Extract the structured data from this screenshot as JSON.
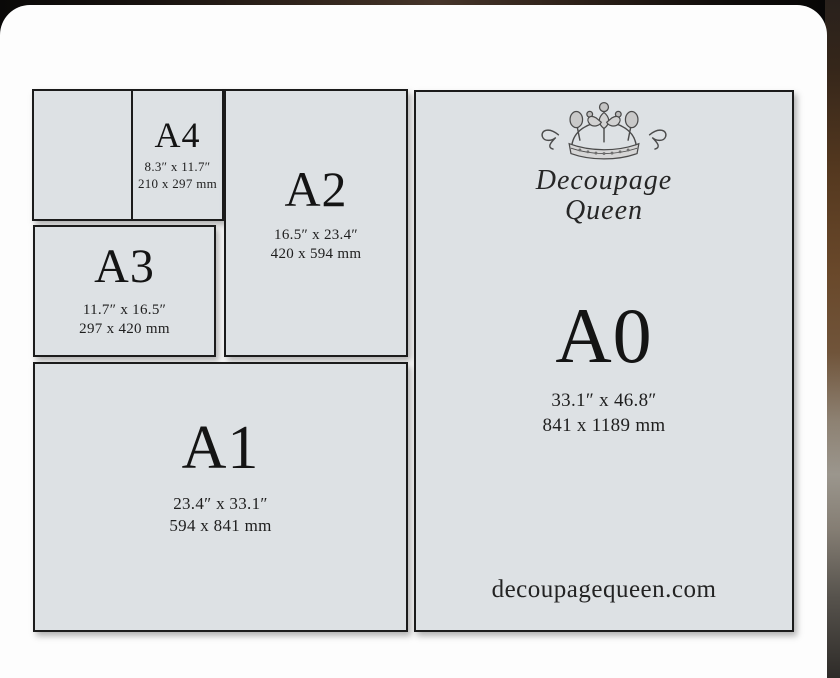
{
  "brand": {
    "line1": "Decoupage",
    "line2": "Queen",
    "website": "decoupagequeen.com"
  },
  "colors": {
    "paper_fill": "#dde1e4",
    "border_line": "#1b1b1b",
    "card_background": "#fdfdfd",
    "backdrop_brown": "#69482a"
  },
  "sizes": [
    {
      "id": "a4",
      "label": "A4",
      "inches": "8.3″ x 11.7″",
      "mm": "210 x 297 mm"
    },
    {
      "id": "a3",
      "label": "A3",
      "inches": "11.7″ x 16.5″",
      "mm": "297 x 420 mm"
    },
    {
      "id": "a2",
      "label": "A2",
      "inches": "16.5″ x 23.4″",
      "mm": "420 x 594 mm"
    },
    {
      "id": "a1",
      "label": "A1",
      "inches": "23.4″ x 33.1″",
      "mm": "594 x 841 mm"
    },
    {
      "id": "a0",
      "label": "A0",
      "inches": "33.1″ x 46.8″",
      "mm": "841 x 1189 mm"
    }
  ]
}
